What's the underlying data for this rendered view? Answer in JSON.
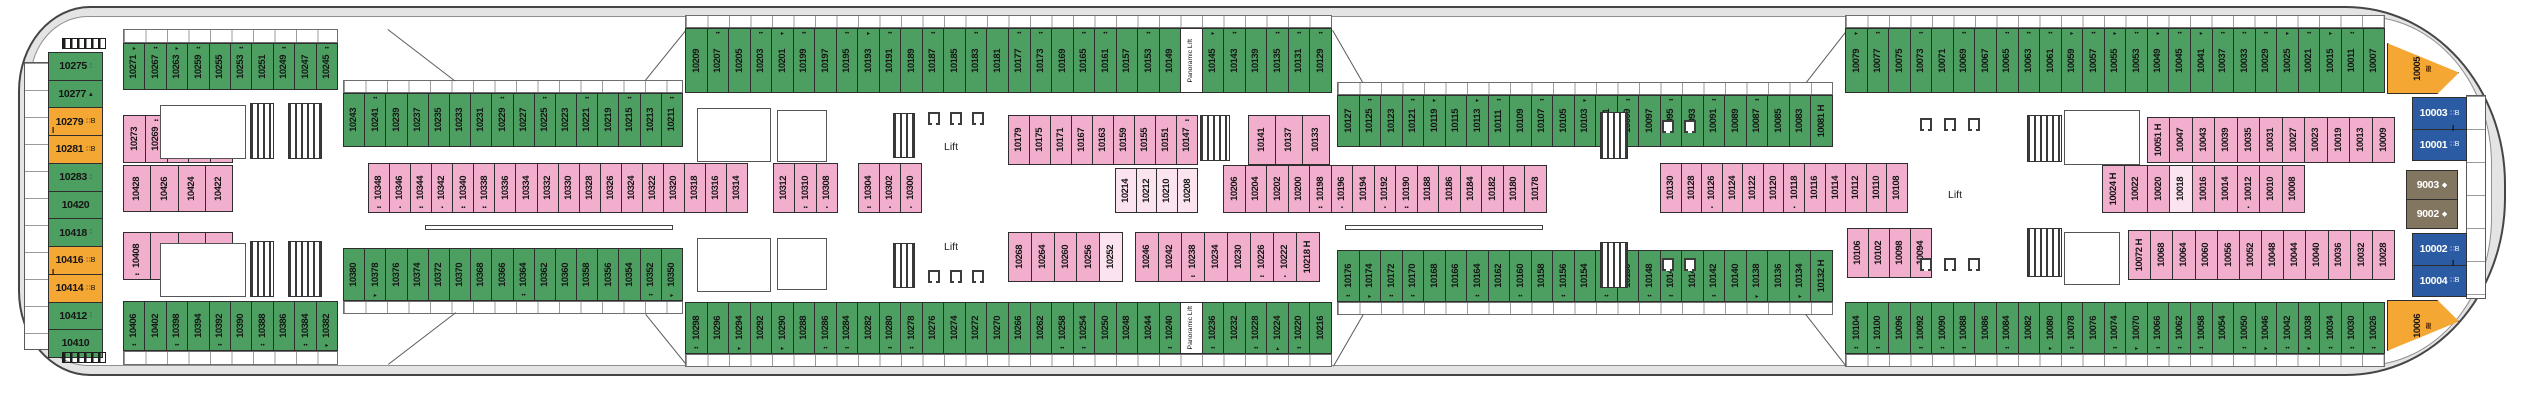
{
  "labels": {
    "lift": "Lift",
    "panoramic_lift": "Panoramic Lift"
  },
  "colors": {
    "balcony_green": "#4d9e61",
    "inside_pink": "#f1aecd",
    "inside_light": "#fbe3f0",
    "suite_orange": "#f5a733",
    "suite_blue": "#2b5ba3",
    "suite_tan": "#837660",
    "hull_gray": "#e4e4e4",
    "outline": "#454545"
  },
  "band_colors": {
    "top_a": "g",
    "top_b": "g",
    "top_c": "g",
    "top_d": "g",
    "top_e": "g",
    "bot_a": "g",
    "bot_b": "g",
    "bot_c": "g",
    "bot_d": "g",
    "bot_e": "g",
    "pink_stern_1": "p",
    "pink_stern_2": "p",
    "pink_stern_3": "p",
    "pink_mid_a": "p",
    "pink_mid_b": "p",
    "pink_mid_c": "p",
    "pink_up_1": "p",
    "pink_up_2": "p",
    "pink_inside": "lp",
    "pink_low_1": "p",
    "pink_low_2": "p",
    "pink_center_right": "p",
    "pink_far": "p",
    "pink_far_low": "p",
    "pink_bow_up": "p",
    "pink_bow_mid": "p",
    "pink_bow_low": "p"
  },
  "stern_column": [
    {
      "n": "10275",
      "c": "g",
      "m": "∶"
    },
    {
      "n": "10277",
      "c": "g",
      "m": "▴"
    },
    {
      "n": "10279",
      "c": "o",
      "m": "∷B"
    },
    {
      "n": "10281",
      "c": "o",
      "m": "∷B"
    },
    {
      "n": "10283",
      "c": "g",
      "m": "∶"
    },
    {
      "n": "10420",
      "c": "g"
    },
    {
      "n": "10418",
      "c": "g",
      "m": "∶"
    },
    {
      "n": "10416",
      "c": "o",
      "m": "∷B"
    },
    {
      "n": "10414",
      "c": "o",
      "m": "∷B"
    },
    {
      "n": "10412",
      "c": "g",
      "m": "∶"
    },
    {
      "n": "10410",
      "c": "g"
    }
  ],
  "bow": {
    "upper": [
      {
        "n": "10003",
        "c": "bl",
        "m": "∷B"
      },
      {
        "n": "10001",
        "c": "bl",
        "m": "∷B"
      }
    ],
    "suites": [
      {
        "n": "9003",
        "c": "tn",
        "m": "◆"
      },
      {
        "n": "9002",
        "c": "tn",
        "m": "◆"
      }
    ],
    "lower": [
      {
        "n": "10002",
        "c": "bl",
        "m": "∷B"
      },
      {
        "n": "10004",
        "c": "bl",
        "m": "∷B"
      }
    ],
    "orange_top": {
      "n": "10005",
      "wave": "≋"
    },
    "orange_bottom": {
      "n": "10006",
      "wave": "≋"
    }
  },
  "bands": {
    "top_a": [
      "10271",
      "10267",
      "10263",
      "10259",
      "10255",
      "10253",
      "10251",
      "10249",
      "10247",
      "10245"
    ],
    "top_b": [
      "10243",
      "10241",
      "10239",
      "10237",
      "10235",
      "10233",
      "10231",
      "10229",
      "10227",
      "10225",
      "10223",
      "10221",
      "10219",
      "10215",
      "10213",
      "10211"
    ],
    "top_c": [
      "10209",
      "10207",
      "10205",
      "10203",
      "10201",
      "10199",
      "10197",
      "10195",
      "10193",
      "10191",
      "10189",
      "10187",
      "10185",
      "10183",
      "10181",
      "10177",
      "10173",
      "10169",
      "10165",
      "10161",
      "10157",
      "10153",
      "10149",
      {
        "n": "Panoramic Lift",
        "c": "lift"
      },
      "10145",
      "10143",
      "10139",
      "10135",
      "10131",
      "10129"
    ],
    "top_d": [
      "10127",
      "10125",
      "10123",
      "10121",
      "10119",
      "10115",
      "10113",
      "10111",
      "10109",
      "10107",
      "10105",
      "10103",
      "10101",
      "10099",
      "10097",
      "10095",
      "10093",
      "10091",
      "10089",
      "10087",
      "10085",
      "10083",
      {
        "n": "10081 H"
      }
    ],
    "top_e": [
      "10079",
      "10077",
      "10075",
      "10073",
      "10071",
      "10069",
      "10067",
      "10065",
      "10063",
      "10061",
      "10059",
      "10057",
      "10055",
      "10053",
      "10049",
      "10045",
      "10041",
      "10037",
      "10033",
      "10029",
      "10025",
      "10021",
      "10015",
      "10011",
      "10007"
    ],
    "bot_a": [
      "10406",
      "10402",
      "10398",
      "10394",
      "10392",
      "10390",
      "10388",
      "10386",
      "10384",
      "10382"
    ],
    "bot_b": [
      "10380",
      "10378",
      "10376",
      "10374",
      "10372",
      "10370",
      "10368",
      "10366",
      "10364",
      "10362",
      "10360",
      "10358",
      "10356",
      "10354",
      "10352",
      "10350"
    ],
    "bot_c": [
      "10298",
      "10296",
      "10294",
      "10292",
      "10290",
      "10288",
      "10286",
      "10284",
      "10282",
      "10280",
      "10278",
      "10276",
      "10274",
      "10272",
      "10270",
      "10266",
      "10262",
      "10258",
      "10254",
      "10250",
      "10248",
      "10244",
      "10240",
      {
        "n": "Panoramic Lift",
        "c": "lift"
      },
      "10236",
      "10232",
      "10228",
      "10224",
      "10220",
      "10216"
    ],
    "bot_d": [
      "10176",
      "10174",
      "10172",
      "10170",
      "10168",
      "10166",
      "10164",
      "10162",
      "10160",
      "10158",
      "10156",
      "10154",
      "10152",
      "10150",
      "10148",
      "10146",
      "10144",
      "10142",
      "10140",
      "10138",
      "10136",
      "10134",
      {
        "n": "10132 H"
      }
    ],
    "bot_e": [
      "10104",
      "10100",
      "10096",
      "10092",
      "10090",
      "10088",
      "10086",
      "10084",
      "10082",
      "10080",
      "10078",
      "10076",
      "10074",
      "10070",
      "10066",
      "10062",
      "10058",
      "10054",
      "10050",
      "10046",
      "10042",
      "10038",
      "10034",
      "10030",
      "10026"
    ],
    "pink_stern_1": [
      "10273",
      "10269",
      "10265",
      "10261",
      "10257"
    ],
    "pink_stern_2": [
      "10428",
      "10426",
      "10424",
      "10422"
    ],
    "pink_stern_3": [
      "10408",
      "10404",
      "10400",
      "10396"
    ],
    "pink_mid_a": [
      "10348",
      "10346",
      "10344",
      "10342",
      "10340",
      "10338",
      "10336",
      "10334",
      "10332",
      "10330",
      "10328",
      "10326",
      "10324",
      "10322",
      "10320",
      "10318",
      "10316",
      "10314"
    ],
    "pink_mid_b": [
      "10312",
      "10310",
      "10308"
    ],
    "pink_mid_c": [
      "10304",
      "10302",
      "10300"
    ],
    "pink_up_1": [
      "10179",
      "10175",
      "10171",
      "10167",
      "10163",
      "10159",
      "10155",
      "10151",
      "10147"
    ],
    "pink_up_2": [
      "10141",
      "10137",
      "10133"
    ],
    "pink_inside": [
      {
        "n": "10214",
        "c": "lp"
      },
      {
        "n": "10212",
        "c": "lp"
      },
      {
        "n": "10210",
        "c": "lp"
      },
      {
        "n": "10208",
        "c": "lp"
      }
    ],
    "pink_low_1": [
      "10268",
      "10264",
      "10260",
      "10256",
      {
        "n": "10252",
        "c": "lp"
      }
    ],
    "pink_low_2": [
      "10246",
      "10242",
      "10238",
      "10234",
      "10230",
      "10226",
      "10222",
      {
        "n": "10218 H"
      }
    ],
    "pink_center_right": [
      "10206",
      "10204",
      "10202",
      "10200",
      "10198",
      "10196",
      "10194",
      "10192",
      "10190",
      "10188",
      "10186",
      "10184",
      "10182",
      "10180",
      "10178"
    ],
    "pink_far": [
      "10130",
      "10128",
      "10126",
      "10124",
      "10122",
      "10120",
      "10118",
      "10116",
      "10114",
      "10112",
      "10110",
      "10108"
    ],
    "pink_far_low": [
      "10106",
      "10102",
      "10098",
      "10094"
    ],
    "pink_bow_up": [
      {
        "n": "10051 H"
      },
      "10047",
      "10043",
      "10039",
      "10035",
      "10031",
      "10027",
      "10023",
      "10019",
      "10013",
      "10009"
    ],
    "pink_bow_mid": [
      {
        "n": "10024 H"
      },
      "10022",
      "10020",
      {
        "n": "10018",
        "c": "lp"
      },
      "10016",
      "10014",
      "10012",
      "10010",
      "10008"
    ],
    "pink_bow_low": [
      {
        "n": "10072 H"
      },
      "10068",
      "10064",
      "10060",
      "10056",
      "10052",
      "10048",
      "10044",
      "10040",
      "10036",
      "10032",
      "10028"
    ]
  },
  "marks": {
    "10271": "▸",
    "10267": "••",
    "10263": "▸",
    "10259": "••",
    "10253": "••",
    "10249": "••",
    "10245": "••",
    "10241": "••",
    "10229": "••",
    "10225": "••",
    "10221": "••",
    "10215": "••",
    "10211": "••",
    "10207": "••",
    "10203": "••",
    "10201": "▸",
    "10199": "••",
    "10195": "••",
    "10193": "▸",
    "10191": "••",
    "10187": "••",
    "10183": "••",
    "10177": "••",
    "10173": "••",
    "10165": "••",
    "10161": "••",
    "10153": "••",
    "10145": "▸",
    "10143": "••",
    "10135": "••",
    "10131": "••",
    "10129": "••",
    "10125": "••",
    "10121": "••",
    "10119": "▸",
    "10113": "▸",
    "10111": "••",
    "10107": "••",
    "10103": "▸",
    "10099": "••",
    "10095": "••",
    "10091": "••",
    "10087": "••",
    "10079": "▸",
    "10077": "••",
    "10073": "••",
    "10069": "••",
    "10065": "••",
    "10063": "••",
    "10061": "••",
    "10059": "▸",
    "10057": "••",
    "10055": "▸",
    "10053": "••",
    "10049": "▸",
    "10045": "••",
    "10041": "▸",
    "10037": "••",
    "10033": "••",
    "10029": "••",
    "10025": "▸",
    "10021": "••",
    "10015": "▸",
    "10011": "••",
    "10406": "••",
    "10398": "••",
    "10392": "••",
    "10388": "••",
    "10384": "••",
    "10382": "▸",
    "10378": "▸",
    "10364": "••",
    "10352": "••",
    "10350": "▸",
    "10298": "••",
    "10294": "▸",
    "10290": "▸",
    "10286": "••",
    "10284": "••",
    "10280": "••",
    "10278": "••",
    "10258": "••",
    "10254": "••",
    "10240": "••",
    "10236": "••",
    "10228": "••",
    "10224": "▴",
    "10220": "••",
    "10176": "••",
    "10174": "▸",
    "10172": "••",
    "10170": "••",
    "10164": "••",
    "10160": "••",
    "10156": "••",
    "10152": "••",
    "10148": "••",
    "10146": "••",
    "10142": "••",
    "10138": "▸",
    "10134": "▸",
    "10104": "••",
    "10100": "••",
    "10092": "••",
    "10090": "••",
    "10088": "••",
    "10084": "••",
    "10080": "▸",
    "10078": "••",
    "10074": "••",
    "10070": "▸",
    "10066": "••",
    "10062": "••",
    "10058": "••",
    "10050": "••",
    "10046": "▸",
    "10042": "••",
    "10038": "▸",
    "10034": "••",
    "10030": "••",
    "10026": "••",
    "10348": "▪▪",
    "10346": "▪",
    "10344": "▪▪",
    "10342": "▪",
    "10340": "▪▪",
    "10338": "▪▪",
    "10310": "▪▪",
    "10308": "▪",
    "10304": "▪▪",
    "10302": "▪",
    "10300": "▪",
    "10408": "▪▪",
    "10404": "▪",
    "10400": "▪▪",
    "10269": "▪▪",
    "10265": "▪▪",
    "10261": "▪▪",
    "10147": "▪▪",
    "10238": "▪▪",
    "10226": "▪▪",
    "10222": "▪",
    "10198": "▪▪",
    "10196": "▪",
    "10192": "▪",
    "10190": "▪▪",
    "10126": "▪",
    "10118": "▪",
    "10012": "▪"
  }
}
